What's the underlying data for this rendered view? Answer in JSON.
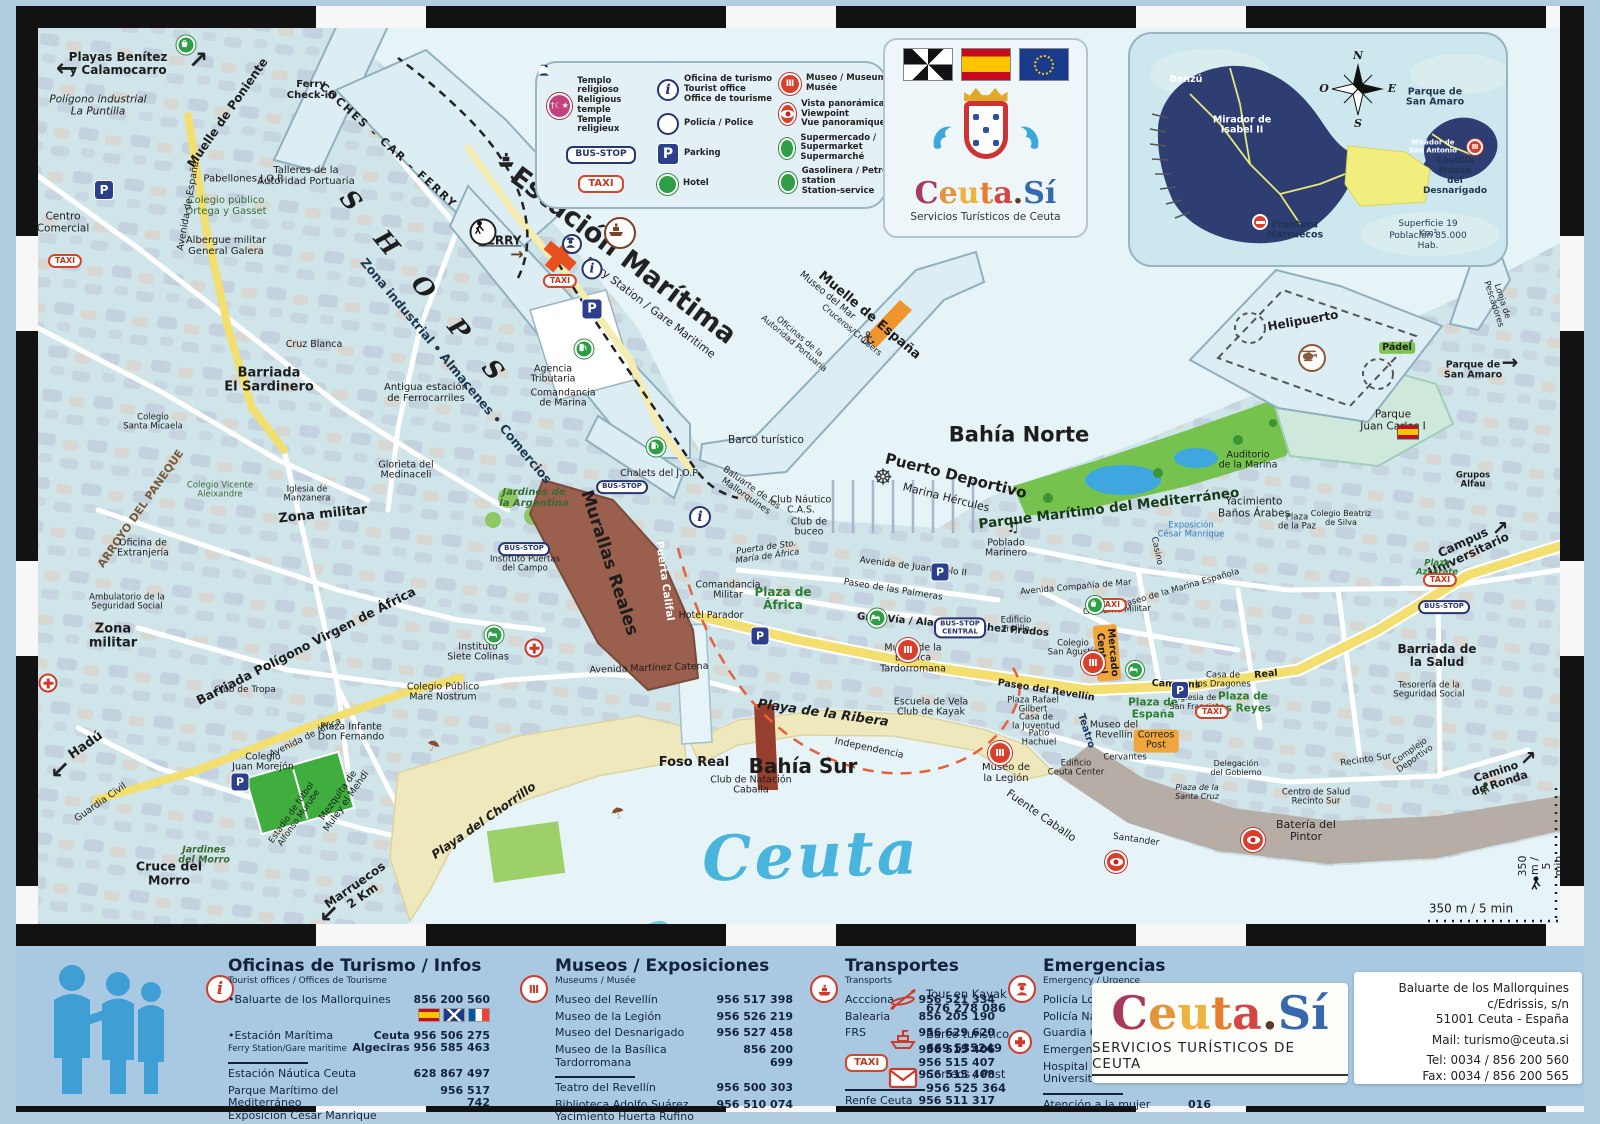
{
  "legend": {
    "temple": "Templo religioso\nReligious temple\nTemple religieux",
    "tourist_office": "Oficina de turismo\nTourist office\nOffice de tourisme",
    "museum": "Museo / Museum\nMusée",
    "bus_stop": "BUS-STOP",
    "police": "Policía / Police",
    "viewpoint": "Vista panorámica / Viewpoint\nVue panoramique",
    "taxi": "TAXI",
    "parking": "Parking",
    "parking_glyph": "P",
    "info_glyph": "i",
    "supermarket": "Supermercado / Supermarket\nSupermarché",
    "hotel": "Hotel",
    "petrol": "Gasolinera / Petrol station\nStation-service"
  },
  "flags_panel": {
    "logo_letters": [
      "C",
      "e",
      "u",
      "t",
      "a",
      ".",
      "S",
      "í"
    ],
    "logo_sub": "Servicios Turísticos de Ceuta"
  },
  "inset": {
    "compass": {
      "n": "N",
      "o": "O",
      "e": "E",
      "s": "S"
    },
    "labels": {
      "benzu": "Benzú",
      "mirador_isabel": "Mirador de\nIsabel II",
      "parque_san_amaro": "Parque de\nSan Amaro",
      "mirador_antonio": "Mirador de\nSan Antonio",
      "castillo": "Castillo Museo\ndel Desnarigado",
      "frontera": "Frontera\nMarruecos",
      "superficie": "Superficie  19 Km²",
      "poblacion": "Población  85.000 Hab."
    }
  },
  "map": {
    "icons": {
      "taxi": "TAXI",
      "bus_stop": "BUS-STOP",
      "bus_stop_central": "BUS-STOP\nCENTRAL",
      "parking": "P",
      "info": "i",
      "museum": "Ⅲ"
    },
    "glyphs": {
      "anchor": "⚓",
      "wheel": "☸",
      "music": "♫",
      "umbrella": "☂",
      "arrow_left": "←",
      "arrow_sw": "↙",
      "arrow_ne": "↗",
      "arrow_e": "→"
    },
    "labels": {
      "playas_benitez": "Playas Benítez\ny Calamocarro",
      "poligono_puntilla": "Polígono industrial\nLa Puntilla",
      "muelle_poniente": "Muelle de Poniente",
      "coches_car_ferry": "COCHES – CAR – FERRY",
      "ferry_checkin": "Ferry\nCheck-in",
      "shops": "S H O P S",
      "estacion_maritima": "Estación Marítima",
      "ferry_station": "Ferry Station / Gare Maritime",
      "ferry": "FERRY",
      "zona_industrial": "Zona industrial • Almacenes • Comercios",
      "antigua_estacion": "Antigua estación\nde Ferrocarriles",
      "agencia_tributaria": "Agencia\nTributaria",
      "comandancia_marina": "Comandancia\nde Marina",
      "cruz_blanca": "Cruz Blanca",
      "barriada_sardinero": "Barriada\nEl Sardinero",
      "pabellones_jop": "Pabellones J.O.P.",
      "talleres": "Talleres de la\nAutoridad Portuaria",
      "colegio_ortega": "Colegio público\nOrtega y Gasset",
      "albergue": "Albergue militar\nGeneral Galera",
      "centro_comercial": "Centro\nComercial",
      "avenida_espana": "Avenida de España",
      "museo_mar": "Museo del Mar",
      "oficinas_autoridad": "Oficinas de la\nAutoridad Portuaria",
      "cruceros": "Cruceros/Cruisers",
      "muelle_espana": "Muelle de España",
      "bahia_norte": "Bahía Norte",
      "barco_turistico": "Barco turístico",
      "puerto_deportivo": "Puerto Deportivo",
      "marina_hercules": "Marina Hércules",
      "club_nautico": "Club Náutico\nC.A.S.",
      "club_buceo": "Club de\nbuceo",
      "chalets_jop": "Chalets del J.O.P",
      "jardines_argentina": "Jardines de\nla Argentina",
      "glorieta_medinaceli": "Glorieta del\nMedinaceli",
      "baluarte": "Baluarte de los\nMallorquines",
      "murallas_reales": "Murallas Reales",
      "puerta_califal": "Puerta Califal",
      "foso_real": "Foso Real",
      "comandancia_militar": "Comandancia\nMilitar",
      "hotel_parador": "Hotel Parador",
      "plaza_africa": "Plaza de\nÁfrica",
      "puerta_sto_maria": "Puerta de Sto.\nMaría de África",
      "av_juan_pablo": "Avenida de Juan Pablo II",
      "paseo_palmeras": "Paseo de las Palmeras",
      "gran_via": "Gran Vía / Alacaide Sáchez Prados",
      "museo_basilica": "Museo de la\nBasílica\nTardorromana",
      "mercado_central": "Mercado\nCentral",
      "independencia": "Independencia",
      "club_natacion": "Club de Natación\nCaballa",
      "escuela_vela": "Escuela de Vela\nClub de Kayak",
      "playa_ribera": "Playa de la Ribera",
      "bahia_sur": "Bahía Sur",
      "playa_chorrillo": "Playa del Chorrillo",
      "ceuta_script": "Ceuta",
      "av_martinez_catena": "Avenida Martínez Catena",
      "hadu": "Hadú",
      "guardia_civil": "Guardia Civil",
      "estadio": "Estadio de fútbol\nAlfonso Murube",
      "cruce_morro": "Cruce del\nMorro",
      "jardines_morro": "Jardines\ndel Morro",
      "colegio_morejon": "Colegio\nJuan Morejón",
      "mezquita": "Mezquita de\nMuley el Mehdi",
      "plaza_infante": "Plaza Infante\nDon Fernando",
      "marruecos": "Marruecos\n2 Km",
      "poblado_marinero": "Poblado\nMarinero",
      "parque_maritimo": "Parque Marítimo del Mediterráneo",
      "exposicion_cesar": "Exposición\nCésar Manrique",
      "casino": "Casino",
      "av_compania_mar": "Avenida Compañía de Mar",
      "paseo_marina": "Paseo de la Marina Española",
      "edificio_trujillo": "Edificio\nTrujillo",
      "colegio_agustin": "Colegio\nSan Agustín",
      "paseo_revellin": "Paseo del Revellín",
      "plaza_rafael": "Plaza Rafael\nGilbert",
      "casa_juventud": "Casa de\nla Juventud",
      "patio_hachuel": "Patio\nHachuel",
      "museo_revellin": "Museo del\nRevellín",
      "teatro": "Teatro",
      "plaza_espana": "Plaza de\nEspaña",
      "correos": "Correos\nPost",
      "camoens": "Camoens",
      "real": "Real",
      "casa_dragones": "Casa de\nlos Dragones",
      "plaza_reyes": "Plaza de\nlos Reyes",
      "iglesia_san_francisco": "Iglesia de\nSan Francisco",
      "museo_legion": "Museo de\nla Legión",
      "fuente_caballo": "Fuente Caballo",
      "santander": "Santander",
      "bateria_pintor": "Batería del\nPintor",
      "recinto_sur": "Recinto Sur",
      "camino_ronda": "Camino\nde Ronda",
      "scale": "350 m / 5 min",
      "scale_v": "350 m / 5 min",
      "yacimiento_banos": "Yacimiento\nBaños Árabes",
      "plaza_paz": "Plaza\nde la Paz",
      "auditorio": "Auditorio\nde la Marina",
      "parque_jc1": "Parque\nJuan Carlos I",
      "helipuerto": "Helipuerto",
      "padel": "Pádel",
      "parque_san_amaro": "Parque de\nSan Amaro",
      "lonja": "Lonja de Pescadores",
      "grupos_alfau": "Grupos\nAlfau",
      "campus": "Campus\nUniversitario",
      "plaza_azcarate": "Plaza\nAzcárate",
      "barriada_salud": "Barriada de\nla Salud",
      "tesoreria": "Tesorería de la\nSeguridad Social",
      "complejo_deportivo": "Complejo\nDeportivo",
      "zona_militar_e": "Zona militar",
      "zona_militar_w": "Zona\nmilitar",
      "arroyo_paneque": "ARROYO DEL PANEQUE",
      "oficina_extranjeria": "Oficina de\nExtranjería",
      "ambulatorio": "Ambulatorio de la\nSeguridad Social",
      "club_tropa": "Club de Tropa",
      "barriada_poligono": "Barriada Polígono Virgen de África",
      "instituto_colinas": "Instituto\nSiete Colinas",
      "colegio_mare": "Colegio Público\nMare Nostrum",
      "instituto_puertas": "Instituto Puertas\ndel Campo",
      "colegio_micaela": "Colegio\nSanta Micaela",
      "colegio_vicente": "Colegio Vicente\nAleixandre",
      "iglesia_manzanera": "Iglesia de\nManzanera",
      "gobierno_militar": "Gobierno Militar",
      "av_africa": "Avenida de África",
      "colegio_beatriz": "Colegio Beatriz\nde Silva",
      "cervantes": "Cervantes",
      "plaza_santa_cruz": "Plaza de la\nSanta Cruz",
      "delegacion_gobierno": "Delegación\ndel Gobierno",
      "edificio_ceuta_center": "Edificio\nCeuta Center",
      "centro_salud": "Centro de Salud\nRecinto Sur"
    }
  },
  "info_panel": {
    "tourism": {
      "title": "Oficinas de Turismo / Infos",
      "subtitle": "Tourist offices / Offices de Tourisme",
      "r1_label": "•Baluarte de los Mallorquines",
      "r1_phone": "856 200 560",
      "r2_label": "•Estación Marítima",
      "r2_sub": "Ferry Station/Gare maritime",
      "r2a": "Ceuta  956 506 275",
      "r2b": "Algeciras  956 585 463",
      "r3_label": "Estación Náutica Ceuta",
      "r3_phone": "628 867 497",
      "r4_label": "Parque Marítimo del Mediterráneo\nExposición César Manrique",
      "r4_phone": "956 517 742"
    },
    "museums": {
      "title": "Museos / Exposiciones",
      "subtitle": "Museums / Musée",
      "r1_label": "Museo del Revellín",
      "r1_phone": "956 517 398",
      "r2_label": "Museo de la Legión",
      "r2_phone": "856 205 190",
      "r2_phone_fix": "956 526 219",
      "r3_label": "Museo del Desnarigado",
      "r3_phone": "956 527 458",
      "r4_label": "Museo de la Basílica Tardorromana",
      "r4_phone": "856 200 699",
      "r5_label": "Teatro del Revellín",
      "r5_phone": "956 500 303",
      "r6_label": "Biblioteca Adolfo Suárez\nYacimiento Huerta Rufino",
      "r6_phone": "956 510 074"
    },
    "transport": {
      "title": "Transportes",
      "subtitle": "Transports",
      "r1_label": "Accciona",
      "r1_phone": "956 521 334",
      "r2_label": "Balearia",
      "r2_phone": "856 205 190",
      "r3_label": "FRS",
      "r3_phone": "956 629 620",
      "taxi": "TAXI",
      "taxi_phones": "956 515 406\n956 515 407\n956 515 408",
      "renfe_label": "Renfe Ceuta",
      "renfe_phone": "956 511 317"
    },
    "emergency": {
      "title": "Emergencias",
      "subtitle": "Emerg7ency / Urgence",
      "subtitle_fix": "Emergency / Urgence",
      "r1_label": "Policía Local",
      "r1_phone": "112",
      "r2_label": "Policía Nacional",
      "r2_phone": "091",
      "r3_label": "Guardia Civil",
      "r3_phone": "956 502 760",
      "r4_label": "Emergencias",
      "r4_phone": "061",
      "r5_label": "Hospital Universitario",
      "r5_phone": "856 907 000",
      "r6_label": "Atención a la mujer",
      "r6_phone": "016"
    },
    "services": {
      "kayak_label": "Tour en Kayak",
      "kayak_phone": "676 278 086",
      "barco_label": "Barco turístico",
      "barco_phone": "669 535249",
      "correos_label": "Correos / Post",
      "correos_phone": "956 525 364"
    },
    "logo": {
      "letters": [
        "C",
        "e",
        "u",
        "t",
        "a",
        ".",
        "S",
        "í"
      ],
      "sub": "SERVICIOS TURÍSTICOS DE CEUTA"
    },
    "address": {
      "l1": "Baluarte de los Mallorquines",
      "l2": "c/Edrissis, s/n",
      "l3": "51001 Ceuta - España",
      "l4": "Mail: turismo@ceuta.si",
      "l5": "Tel: 0034 / 856 200 560",
      "l6": "Fax: 0034 / 856 200 565"
    }
  }
}
